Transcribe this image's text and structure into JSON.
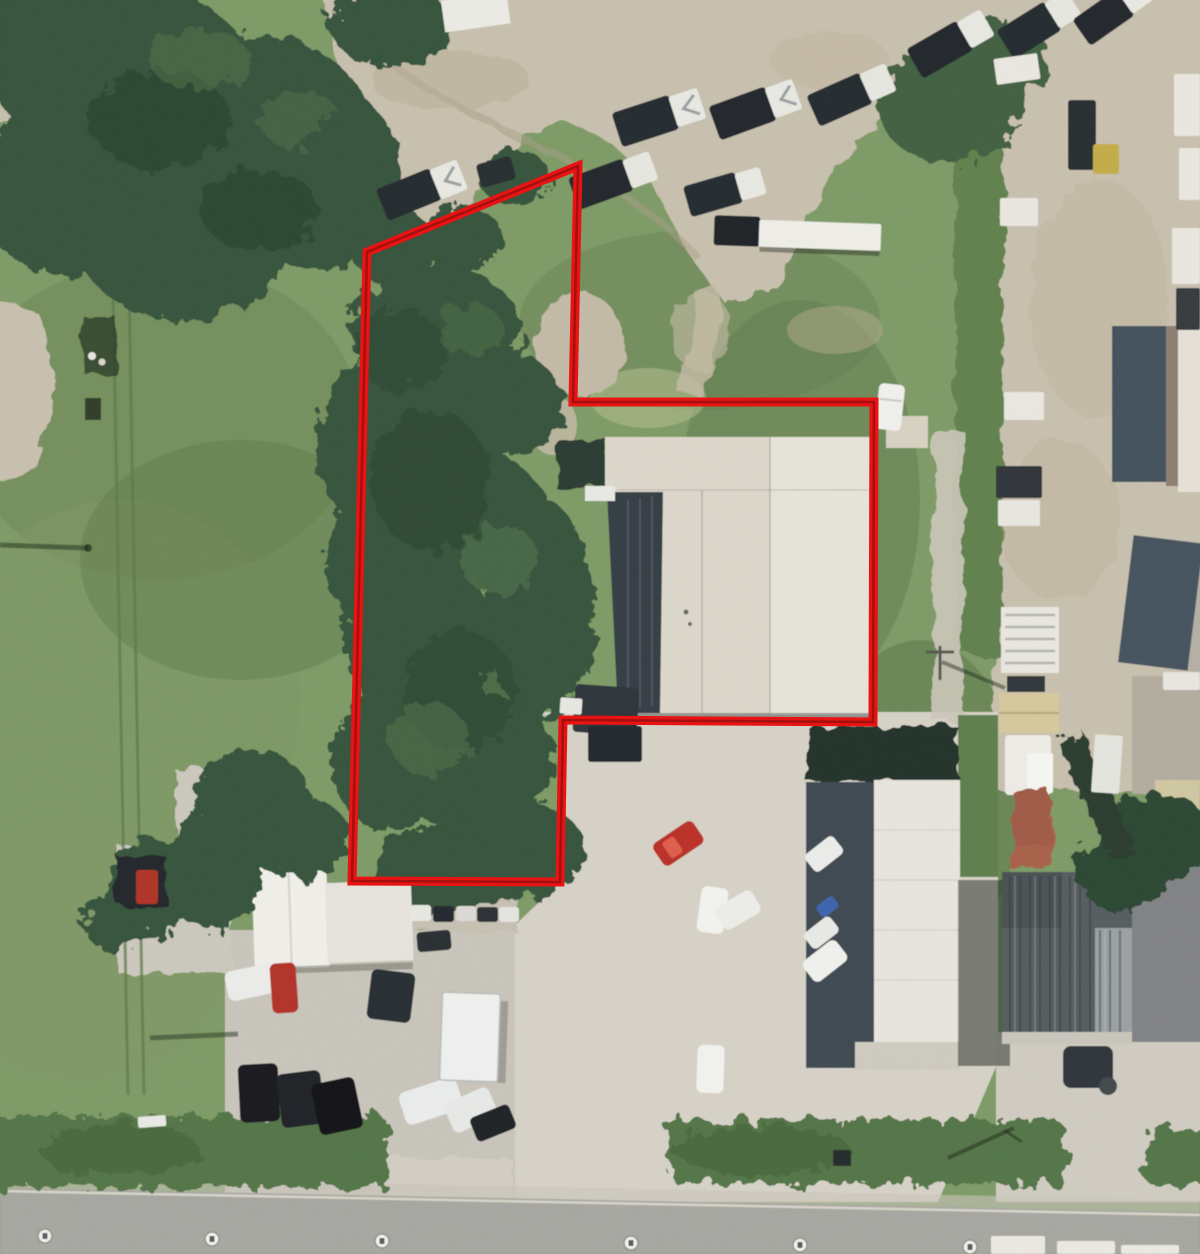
{
  "meta": {
    "type": "aerial-parcel-map",
    "description": "Aerial photograph of an industrial/commercial area with a red property parcel boundary outline; tree-covered L-shaped lot with warehouse, gravel yards, parking lots and a street along the bottom",
    "width": 1200,
    "height": 1254
  },
  "parcel": {
    "outline_color": "#e81414",
    "outline_core_color": "#a50f0f",
    "outline_width": 9,
    "points": "578,166 573,402 874,402 873,722 563,720 560,882 352,881 367,252"
  },
  "road_markers": {
    "count": 6,
    "positions": [
      [
        45,
        1236
      ],
      [
        212,
        1239
      ],
      [
        382,
        1241
      ],
      [
        631,
        1243
      ],
      [
        800,
        1245
      ],
      [
        970,
        1247
      ]
    ]
  },
  "palette": {
    "grass": "#7d9a65",
    "gravel": "#c9c0ae",
    "concrete": "#d7d2c7",
    "trees": "#35523a",
    "verge": "#527546",
    "road": "#a7a7a2",
    "warehouse_roof": "#ddd8cc",
    "warehouse_shadow": "#343d44"
  },
  "features": [
    "tree-covered parcel interior (west half of outline)",
    "large warehouse with dark shaded west face (center-east)",
    "concrete parking lots with cars (south)",
    "gravel equipment yard with boat trailers (north)",
    "gravel trailer yard (east)",
    "white office building (south-west)",
    "ribbed-roof industrial building (south-east)",
    "street with manhole markers (bottom)"
  ]
}
